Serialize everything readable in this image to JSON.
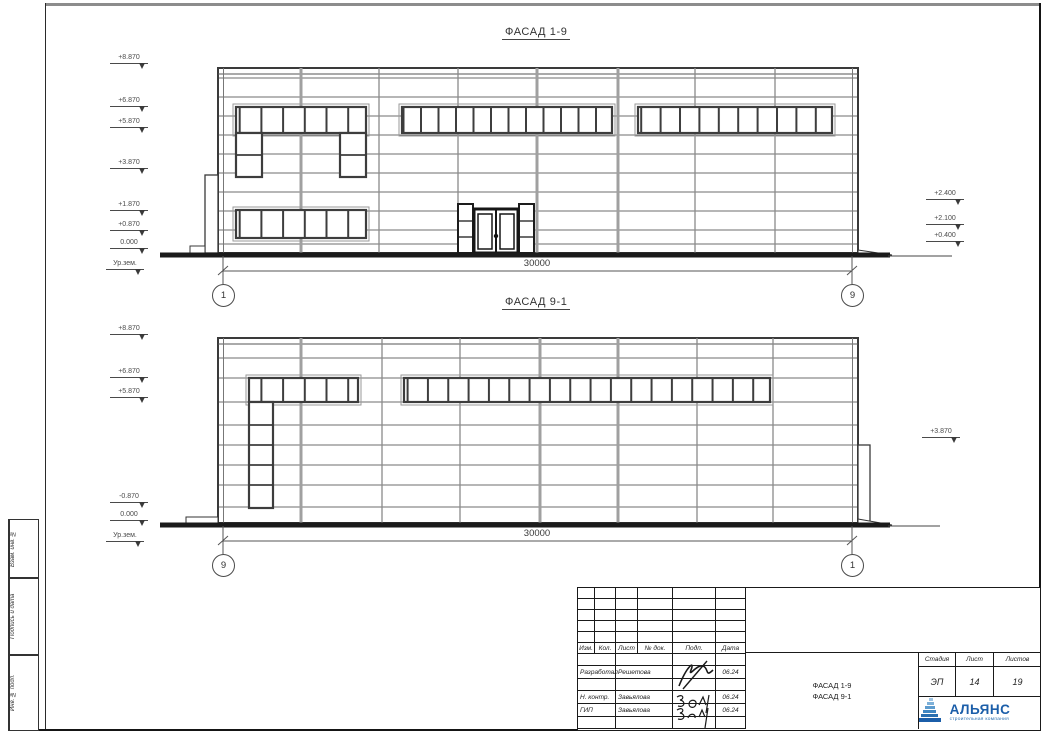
{
  "facades": {
    "f1": {
      "title": "ФАСАД 1-9",
      "dimension": "30000",
      "axis_left": "1",
      "axis_right": "9",
      "left_marks": [
        "+8.870",
        "+6.870",
        "+5.870",
        "+3.870",
        "+1.870",
        "+0.870",
        "0.000",
        "Ур.зем."
      ],
      "right_marks": [
        "+2.400",
        "+2.100",
        "+0.400"
      ]
    },
    "f2": {
      "title": "ФАСАД 9-1",
      "dimension": "30000",
      "axis_left": "9",
      "axis_right": "1",
      "left_marks": [
        "+8.870",
        "+6.870",
        "+5.870",
        "-0.870",
        "0.000",
        "Ур.зем."
      ],
      "right_marks": [
        "+3.870"
      ]
    }
  },
  "side_column": {
    "labels": [
      "Взам. инв. №",
      "Подпись и дата",
      "Инв. № подл."
    ]
  },
  "title_block": {
    "header_cols": [
      "Изм.",
      "Кол.",
      "Лист",
      "№ док.",
      "Подп.",
      "Дата"
    ],
    "rows": [
      {
        "role": "Разработал",
        "name": "Решетова",
        "date": "06.24"
      },
      {
        "role": "Н. контр.",
        "name": "Завьялова",
        "date": "06.24"
      },
      {
        "role": "ГИП",
        "name": "Завьялова",
        "date": "06.24"
      }
    ],
    "doc_title_line1": "ФАСАД 1-9",
    "doc_title_line2": "ФАСАД 9-1",
    "stage_header": "Стадия",
    "sheet_header": "Лист",
    "sheets_header": "Листов",
    "stage": "ЭП",
    "sheet_no": "14",
    "sheets_total": "19",
    "logo": {
      "name": "АЛЬЯНС",
      "tagline": "строительная компания",
      "color": "#1b5ea9"
    }
  }
}
